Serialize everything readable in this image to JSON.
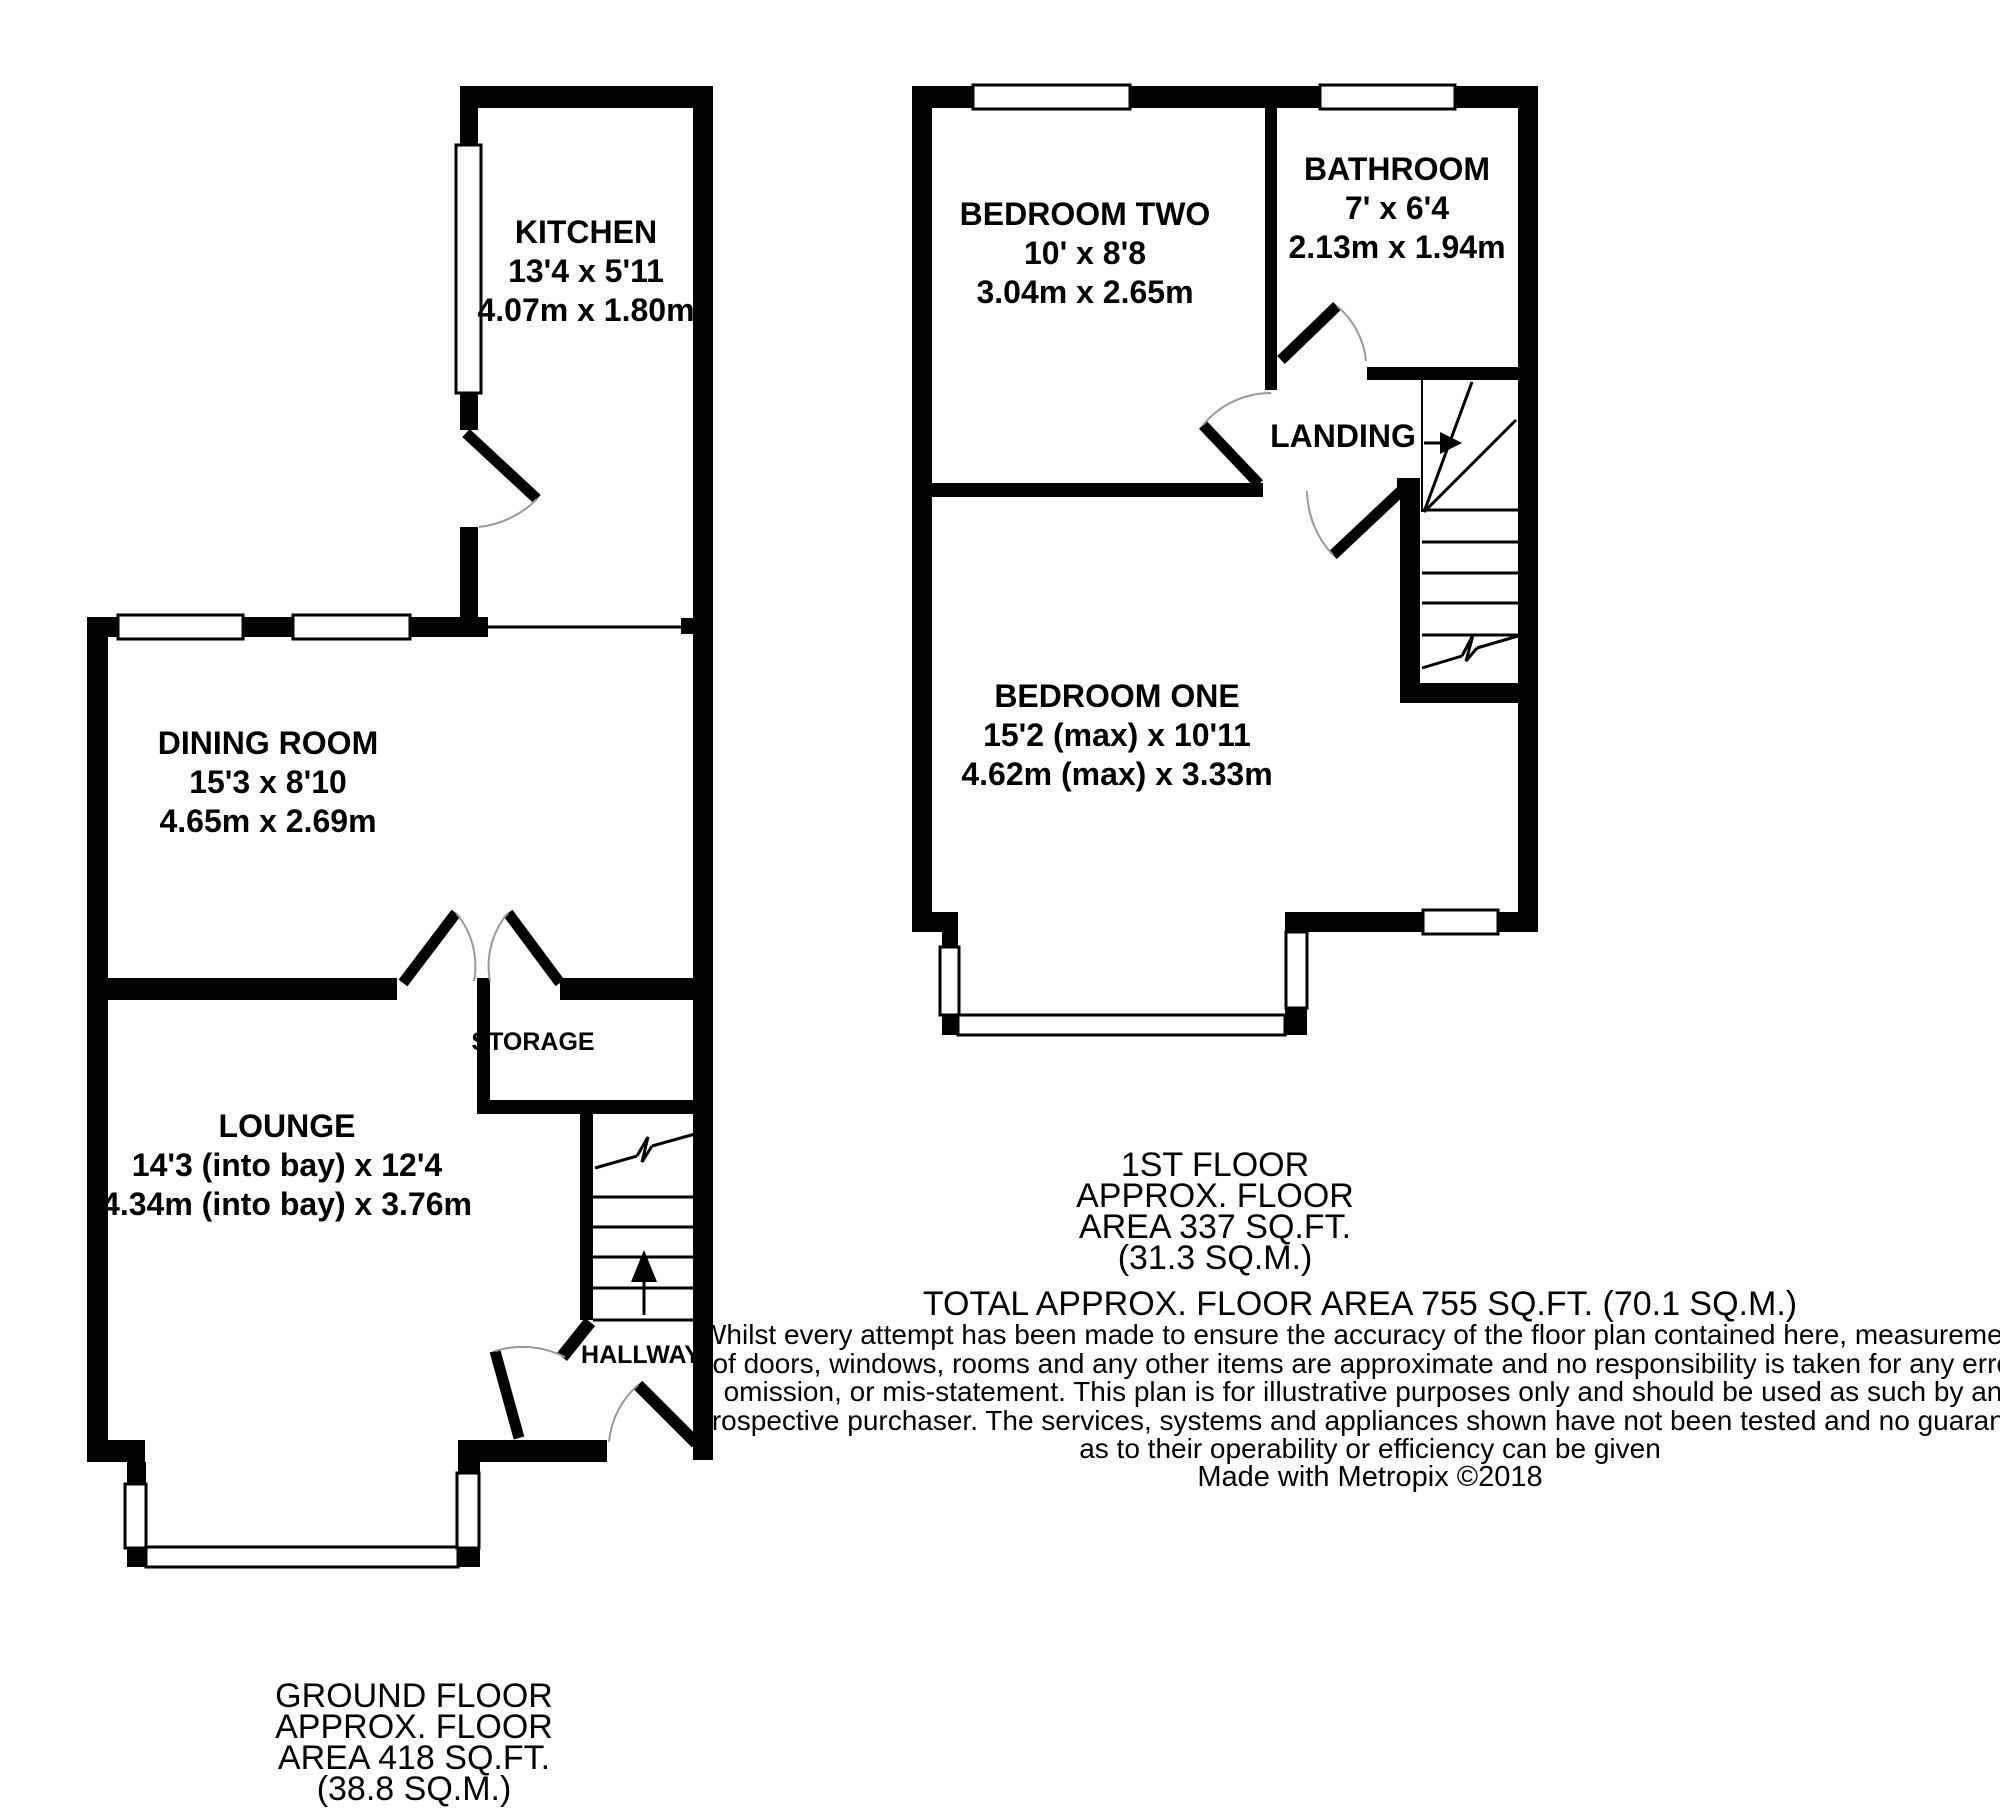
{
  "ground_floor": {
    "caption_lines": [
      "GROUND FLOOR",
      "APPROX. FLOOR",
      "AREA 418 SQ.FT.",
      "(38.8 SQ.M.)"
    ],
    "rooms": {
      "kitchen": {
        "name": "KITCHEN",
        "imperial": "13'4 x 5'11",
        "metric": "4.07m x 1.80m"
      },
      "dining_room": {
        "name": "DINING ROOM",
        "imperial": "15'3 x 8'10",
        "metric": "4.65m x 2.69m"
      },
      "lounge": {
        "name": "LOUNGE",
        "imperial": "14'3 (into bay) x 12'4",
        "metric": "4.34m (into bay) x 3.76m"
      },
      "storage": {
        "name": "STORAGE"
      },
      "hallway": {
        "name": "HALLWAY"
      }
    }
  },
  "first_floor": {
    "caption_lines": [
      "1ST FLOOR",
      "APPROX. FLOOR",
      "AREA 337 SQ.FT.",
      "(31.3 SQ.M.)"
    ],
    "rooms": {
      "bedroom_two": {
        "name": "BEDROOM TWO",
        "imperial": "10' x 8'8",
        "metric": "3.04m x 2.65m"
      },
      "bathroom": {
        "name": "BATHROOM",
        "imperial": "7' x 6'4",
        "metric": "2.13m x 1.94m"
      },
      "landing": {
        "name": "LANDING"
      },
      "bedroom_one": {
        "name": "BEDROOM ONE",
        "imperial": "15'2 (max) x 10'11",
        "metric": "4.62m (max) x 3.33m"
      }
    }
  },
  "total_area_line": "TOTAL APPROX. FLOOR AREA 755 SQ.FT. (70.1 SQ.M.)",
  "disclaimer_lines": [
    "Whilst every attempt has been made to ensure the accuracy of the floor plan contained here, measurements",
    "of doors, windows, rooms and any other items are approximate and no responsibility is taken for any error,",
    "omission, or mis-statement. This plan is for illustrative purposes only and should be used as such by any",
    "prospective purchaser. The services, systems and appliances shown have not been tested and no guarantee",
    "as to their operability or efficiency can be given"
  ],
  "credit": "Made with Metropix ©2018",
  "colors": {
    "wall": "#000000",
    "background": "#ffffff",
    "door_arc": "#999999"
  }
}
